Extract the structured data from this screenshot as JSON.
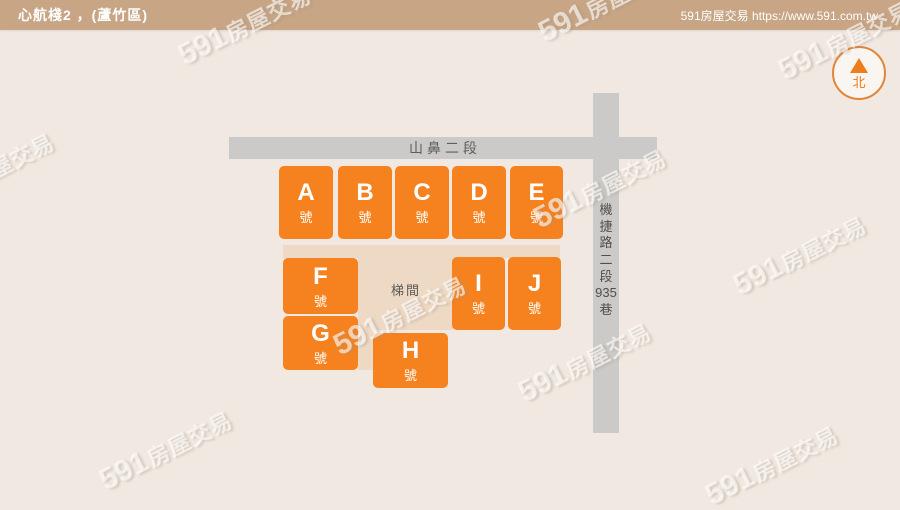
{
  "header": {
    "title": "心航棧2 ，(蘆竹區)",
    "brand": "591房屋交易 https://www.591.com.tw"
  },
  "compass": {
    "north_label": "北"
  },
  "roads": {
    "horizontal_label": "山鼻二段",
    "vertical_label": "機捷路二段935巷",
    "vertical_chars": [
      "機",
      "捷",
      "路",
      "二",
      "段",
      "935",
      "巷"
    ]
  },
  "stairwell_label": "梯間",
  "units": [
    {
      "letter": "A",
      "suffix": "號"
    },
    {
      "letter": "B",
      "suffix": "號"
    },
    {
      "letter": "C",
      "suffix": "號"
    },
    {
      "letter": "D",
      "suffix": "號"
    },
    {
      "letter": "E",
      "suffix": "號"
    },
    {
      "letter": "F",
      "suffix": "號"
    },
    {
      "letter": "G",
      "suffix": "號"
    },
    {
      "letter": "H",
      "suffix": "號"
    },
    {
      "letter": "I",
      "suffix": "號"
    },
    {
      "letter": "J",
      "suffix": "號"
    }
  ],
  "watermark": {
    "digits": "591",
    "word": "房屋交易"
  },
  "colors": {
    "accent_orange": "#F5821F",
    "header_tan": "#C7A585",
    "walkway_tan": "#EDD9C4",
    "road_gray": "#CBCAC8",
    "background": "#F1E9E1",
    "compass_orange": "#EE7D1B"
  }
}
